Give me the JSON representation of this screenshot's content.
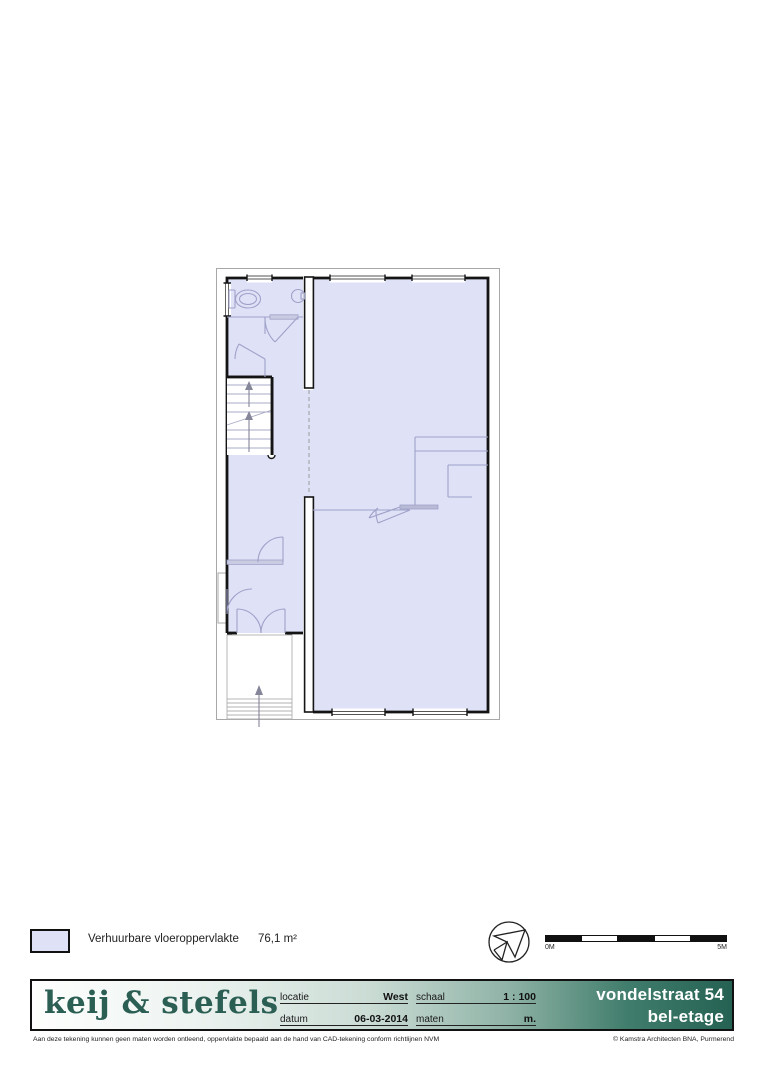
{
  "legend": {
    "label": "Verhuurbare vloeroppervlakte",
    "value": "76,1 m²",
    "swatch_fill": "#dfe1f7"
  },
  "scale_bar": {
    "start_label": "0M",
    "end_label": "5M",
    "segments": 5
  },
  "compass": {
    "icon": "north-arrow"
  },
  "title_block": {
    "logo": "keij & stefels",
    "fields": [
      {
        "label": "locatie",
        "value": "West"
      },
      {
        "label": "datum",
        "value": "06-03-2014"
      },
      {
        "label": "schaal",
        "value": "1 : 100"
      },
      {
        "label": "maten",
        "value": "m."
      }
    ],
    "address_line1": "vondelstraat 54",
    "address_line2": "bel-etage"
  },
  "footer": {
    "disclaimer": "Aan deze tekening kunnen geen maten worden ontleend, oppervlakte bepaald aan de hand van CAD-tekening conform richtlijnen NVM",
    "copyright": "© Kamstra Architecten BNA, Purmerend"
  },
  "colors": {
    "floor_fill": "#dfe1f7",
    "wall": "#141414",
    "fixture_line": "#9fa1c8",
    "teal_dark": "#266253",
    "logo_teal": "#2c5f53"
  }
}
